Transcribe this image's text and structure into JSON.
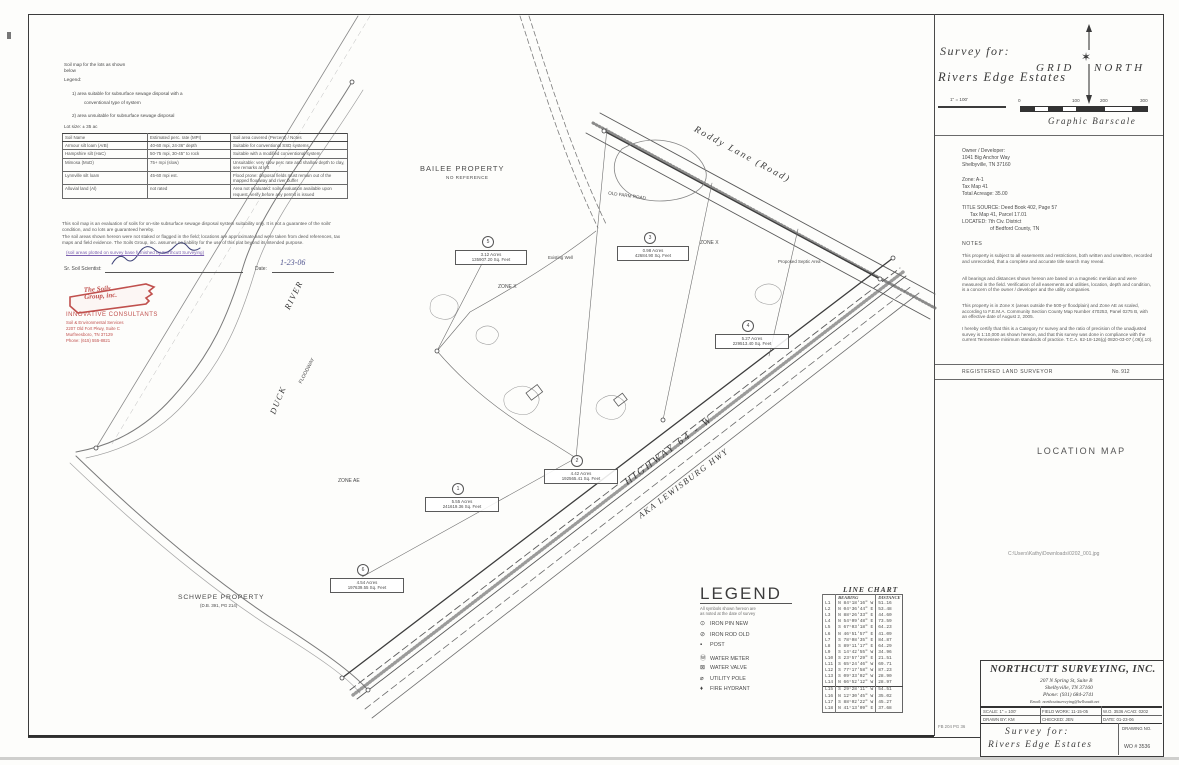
{
  "header": {
    "survey_for_label": "Survey for:",
    "client_name": "Rivers Edge Estates",
    "grid_north": "GRID NORTH",
    "graphic_barscale": "Graphic Barscale",
    "barscale_ticks": [
      "0",
      "100",
      "200",
      "300"
    ],
    "mini_scale": "1\" = 100'"
  },
  "info_panel": {
    "owner_lines": [
      "Owner / Developer:",
      "1041 Big Anchor Way",
      "Shelbyville, TN 37160"
    ],
    "zone": "Zone: A-1",
    "tax_map": "Tax Map 41",
    "acreage": "Total Acreage: 35.00",
    "title_source_1": "TITLE SOURCE: Deed Book 402, Page 57",
    "title_source_2": "Tax Map 41, Parcel 17.01",
    "located_1": "LOCATED: 7th Civ. District",
    "located_2": "of Bedford County, TN",
    "notes_heading": "NOTES",
    "note_paragraphs": [
      "This property is subject to all easements and restrictions, both written and unwritten, recorded and unrecorded, that a complete and accurate title search may reveal.",
      "All bearings and distances shown hereon are based on a magnetic meridian and were measured in the field. Verification of all easements and utilities, location, depth and condition, is a concern of the owner / developer and the utility companies.",
      "This property is in Zone X (areas outside the 500-yr floodplain) and Zone AE as scaled, according to F.E.M.A. Community Section County Map Number 470253, Panel 0275 B, with an effective date of August 2, 2005.",
      "I hereby certify that this is a Category IV survey and the ratio of precision of the unadjusted survey is 1:10,000 as shown hereon, and that this survey was done in compliance with the current Tennessee minimum standards of practice. T.C.A. 62-18-126(g) 0820-03-07 (.06)(.10)."
    ],
    "surveyor_label": "REGISTERED LAND SURVEYOR",
    "surveyor_no": "No. 912",
    "location_map_heading": "LOCATION MAP",
    "file_path": "C:\\Users\\Kathy\\Downloads\\0202_001.jpg",
    "margin_note": "FB 204  PG 36"
  },
  "firm_block": {
    "firm_name": "NORTHCUTT SURVEYING, INC.",
    "address_1": "207 N Spring St, Suite B",
    "address_2": "Shelbyville, TN 37160",
    "phone": "Phone: (931) 684-2741",
    "email": "Email: northcuttsurveying@bellsouth.net",
    "row1": [
      "SCALE: 1\" = 100'",
      "FIELD WORK: 11-15-05",
      "W.O. 3536  ACAD: 0202"
    ],
    "row2": [
      "DRAWN BY: KM",
      "CHECKED: JEN",
      "DATE: 01-23-06"
    ],
    "survey_for_label": "Survey for:",
    "client_name": "Rivers Edge Estates",
    "drawing_no_label": "DRAWING NO.",
    "drawing_no": "WO # 3536"
  },
  "legend": {
    "title": "LEGEND",
    "note_lines": [
      "All symbols shown hereon are",
      "as noted at the date of survey"
    ],
    "items": [
      {
        "sym": "⊙",
        "label": "IRON PIN NEW"
      },
      {
        "sym": "⊘",
        "label": "IRON ROD OLD"
      },
      {
        "sym": "▪",
        "label": "POST"
      },
      {
        "sym": "Ⓦ",
        "label": "WATER METER"
      },
      {
        "sym": "⊠",
        "label": "WATER VALVE"
      },
      {
        "sym": "⌀",
        "label": "UTILITY POLE"
      },
      {
        "sym": "♦",
        "label": "FIRE HYDRANT"
      }
    ]
  },
  "line_chart": {
    "title": "LINE  CHART",
    "col_bearing": "BEARING",
    "col_distance": "DISTANCE",
    "rows": [
      {
        "id": "L1",
        "bearing": "N 84°18'16\" W",
        "dist": "51.16"
      },
      {
        "id": "L2",
        "bearing": "N 04°36'44\" E",
        "dist": "53.48"
      },
      {
        "id": "L3",
        "bearing": "N 88°26'33\" E",
        "dist": "44.60"
      },
      {
        "id": "L4",
        "bearing": "N 54°09'48\" E",
        "dist": "73.59"
      },
      {
        "id": "L5",
        "bearing": "S 67°03'18\" E",
        "dist": "64.23"
      },
      {
        "id": "L6",
        "bearing": "N 46°51'57\" E",
        "dist": "41.09"
      },
      {
        "id": "L7",
        "bearing": "S 78°08'35\" E",
        "dist": "84.87"
      },
      {
        "id": "L8",
        "bearing": "S 89°11'17\" E",
        "dist": "64.29"
      },
      {
        "id": "L9",
        "bearing": "S 14°42'55\" W",
        "dist": "34.96"
      },
      {
        "id": "L10",
        "bearing": "S 23°57'29\" E",
        "dist": "21.51"
      },
      {
        "id": "L11",
        "bearing": "S 65°24'46\" W",
        "dist": "69.71"
      },
      {
        "id": "L12",
        "bearing": "S 77°17'58\" W",
        "dist": "87.23"
      },
      {
        "id": "L13",
        "bearing": "S 09°33'02\" W",
        "dist": "28.90"
      },
      {
        "id": "L14",
        "bearing": "N 66°52'12\" W",
        "dist": "28.97"
      },
      {
        "id": "L15",
        "bearing": "S 29°28'11\" W",
        "dist": "54.51"
      },
      {
        "id": "L16",
        "bearing": "N 12°30'45\" W",
        "dist": "35.02"
      },
      {
        "id": "L17",
        "bearing": "S 88°02'22\" W",
        "dist": "45.27"
      },
      {
        "id": "L18",
        "bearing": "N 41°13'09\" E",
        "dist": "37.68"
      }
    ]
  },
  "soils_report": {
    "header_lines": [
      "Soil map for the lots as shown",
      "below",
      "Legend:"
    ],
    "legend_items": [
      "1)  area suitable for subsurface sewage disposal with a",
      "conventional type of system",
      "2)  area unsuitable for subsurface sewage disposal",
      "Lot size:  ± 35 ac"
    ],
    "table": {
      "headers": [
        "Soil Name",
        "Estimated perc. rate (MPI)",
        "Soil area covered (Percent) / Notes"
      ],
      "rows": [
        [
          "Armour silt loam (ArB)",
          "40-60 mpi, 24-36\" depth",
          "Suitable for conventional SSD systems"
        ],
        [
          "Hampshire silt (HaC)",
          "50-75 mpi, 30-45\" to rock",
          "Suitable with a modified conventional system"
        ],
        [
          "Mimosa (MoD)",
          "75+ mpi (slow)",
          "Unsuitable: very slow perc rate and shallow depth to clay, see remarks at left"
        ],
        [
          "Lynnville silt loam",
          "45-60 mpi est.",
          "Flood prone: disposal fields must remain out of the mapped floodway and river buffer"
        ],
        [
          "Alluvial land (Al)",
          "not rated",
          "Area not evaluated: soils evaluation available upon request, verify before any permit is issued"
        ]
      ]
    },
    "paragraphs": [
      "This soil map is an evaluation of soils for on-site subsurface sewage disposal system suitability only. It is not a guarantee of the soils' condition, and no lots are guaranteed hereby.",
      "The soil areas shown hereon were not staked or flagged in the field; locations are approximate and were taken from deed references, tax maps and field evidence. The Soils Group, inc. assumes no liability for the use of this plat beyond its intended purpose."
    ],
    "blue_note": "(soil areas plotted on survey base furnished by Northcutt Surveying)",
    "signature_label": "Sr. Soil Scientist:",
    "date_label": "Date:",
    "date_value": "1-23-06",
    "stamp": {
      "company_line1": "The Soils",
      "company_line2": "Group, inc.",
      "tagline": "INNOVATIVE CONSULTANTS",
      "lines": [
        "Soil & Environmental Services",
        "2207 Old Fort Pkwy, Suite C",
        "Murfreesboro, TN 37129",
        "Phone: (615) 555-8821"
      ]
    }
  },
  "map_labels": {
    "bailee": "BAILEE PROPERTY",
    "bailee_ref": "NO REFERENCE",
    "roddy": "Roddy Lane (Road)",
    "duck": "DUCK",
    "river": "RIVER",
    "highway": "HIGHWAY  64 - W",
    "highway_aka": "AKA LEWISBURG HWY",
    "schwepe": "SCHWEPE PROPERTY",
    "schwepe_ref": "(D.B. 391, PG 214)",
    "zone_x": "ZONE X",
    "zone_ae": "ZONE AE",
    "floodway": "FLOODWAY",
    "farm_road": "OLD FARM ROAD",
    "well": "Existing Well",
    "septic": "Proposed Septic Area"
  },
  "lots": [
    {
      "num": "1",
      "acres": "5.55 Acres",
      "sqft": "241619.36 Sq. Feet"
    },
    {
      "num": "2",
      "acres": "4.42 Acres",
      "sqft": "192565.41 Sq. Feet"
    },
    {
      "num": "3",
      "acres": "0.98 Acres",
      "sqft": "42684.90 Sq. Feet"
    },
    {
      "num": "4",
      "acres": "5.27 Acres",
      "sqft": "229513.40 Sq. Feet"
    },
    {
      "num": "5",
      "acres": "3.12 Acres",
      "sqft": "135907.20 Sq. Feet"
    },
    {
      "num": "6",
      "acres": "4.54 Acres",
      "sqft": "197639.55 Sq. Feet"
    }
  ]
}
